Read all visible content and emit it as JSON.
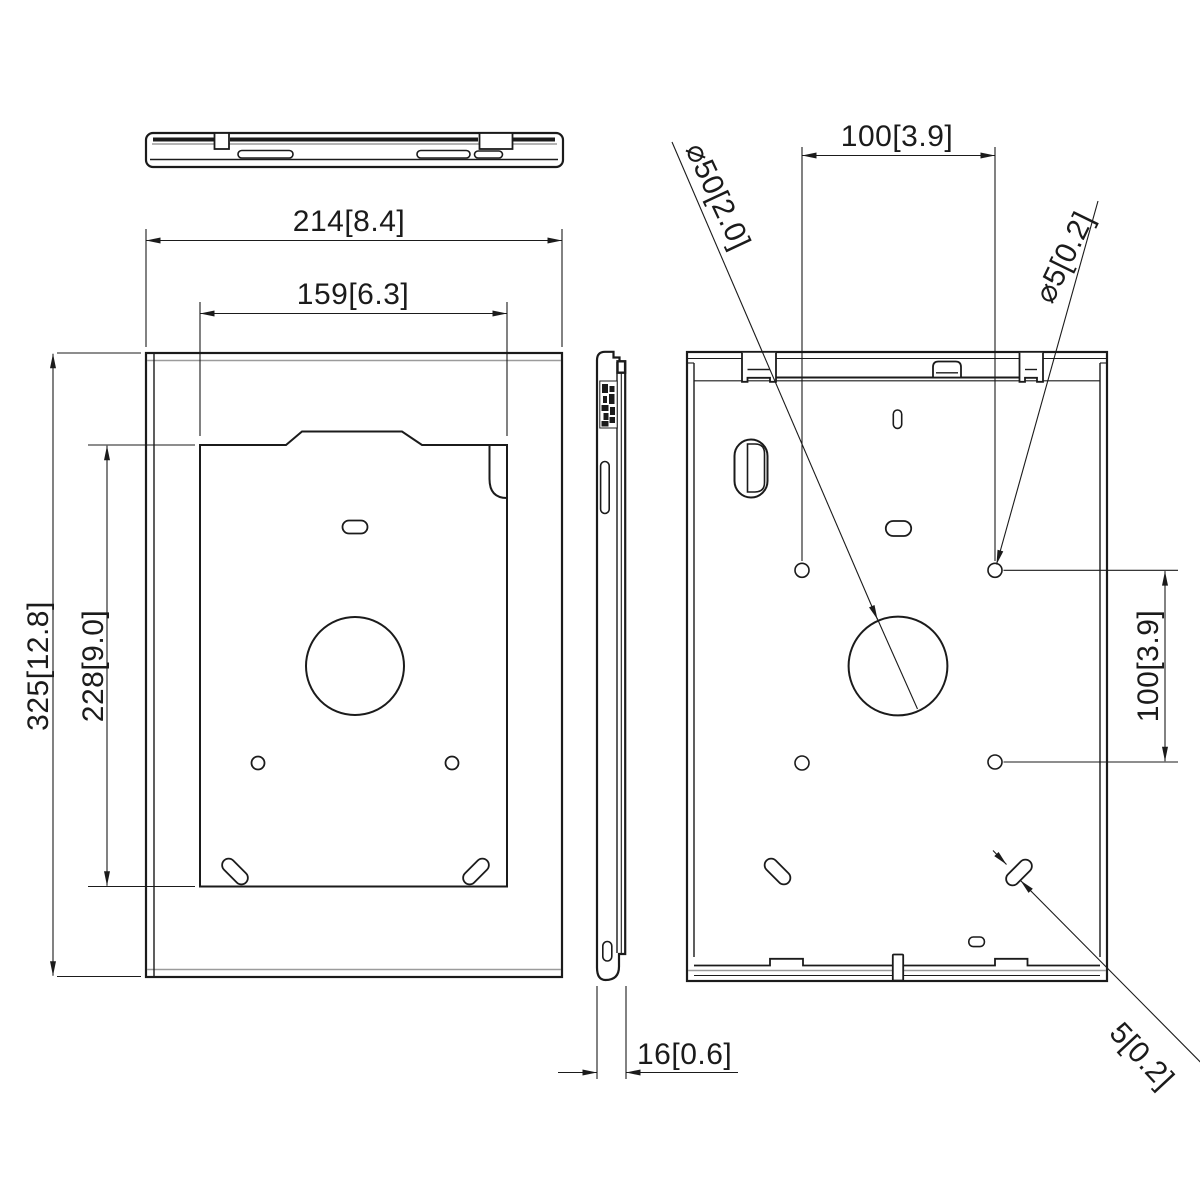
{
  "drawing": {
    "title": "tablet-enclosure-dimension-drawing",
    "background_color": "#ffffff",
    "line_color": "#1b1b1b",
    "tangent_line_color": "#9b9b9b",
    "views": {
      "top_view": "top profile view",
      "front_view": "front view with mounting window",
      "side_view": "side profile view",
      "back_view": "back view with mounting holes"
    },
    "dims": {
      "front_width": "214[8.4]",
      "window_width": "159[6.3]",
      "front_height": "325[12.8]",
      "window_height": "228[9.0]",
      "depth": "16[0.6]",
      "hole_pitch_horizontal": "100[3.9]",
      "hole_pitch_vertical": "100[3.9]",
      "large_hole_diameter": "⌀50[2.0]",
      "small_hole_diameter": "⌀5[0.2]",
      "slot_width": "5[0.2]"
    }
  }
}
